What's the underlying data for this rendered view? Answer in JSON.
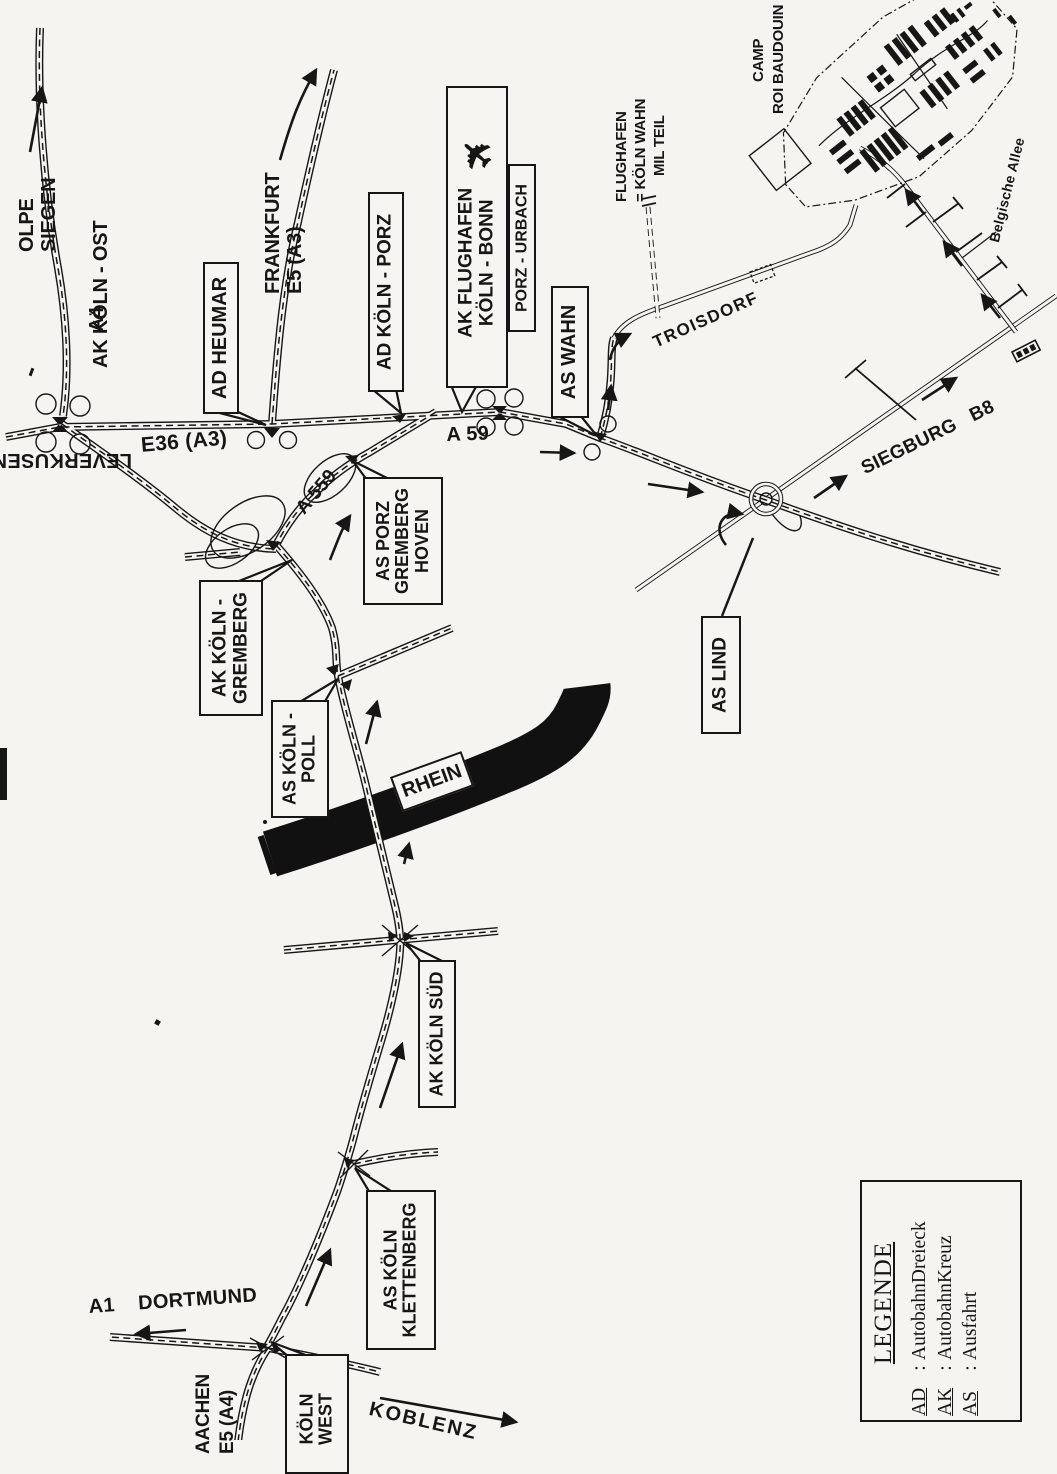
{
  "colors": {
    "paper": "#f5f4f0",
    "ink": "#161616"
  },
  "labels": {
    "olpe": "OLPE",
    "siegen": "SIEGEN",
    "a4": "A4",
    "ak_koeln_ost": "AK KÖLN - OST",
    "frankfurt": "FRANKFURT",
    "e5_a3": "E5 (A3)",
    "e36_a3": "E36 (A3)",
    "leverkusen": "LEVERKUSEN",
    "a_559": "A 559",
    "a_59": "A 59",
    "troisdorf": "TROISDORF",
    "flughafen": "FLUGHAFEN",
    "koeln_wahn": "= KÖLN WAHN",
    "mil_teil": "MIL TEIL",
    "camp": "CAMP",
    "roi_baudouin": "ROI BAUDOUIN",
    "belgische_allee": "Belgische Allee",
    "siegburg_b8": "SIEGBURG   B8",
    "rhein": "RHEIN",
    "a1_dortmund": "A1    DORTMUND",
    "koblenz": "KOBLENZ",
    "aachen": "AACHEN",
    "e5_a4": "E5 (A4)"
  },
  "junction_boxes": {
    "ad_heumar": "AD HEUMAR",
    "ad_koeln_porz": "AD KÖLN - PORZ",
    "ak_flughafen": {
      "line1": "AK FLUGHAFEN",
      "line2": "KÖLN - BONN"
    },
    "porz_urbach": "PORZ - URBACH",
    "as_wahn": "AS WAHN",
    "as_porz_gremberg_hoven": {
      "line1": "AS PORZ",
      "line2": "GREMBERG",
      "line3": "HOVEN"
    },
    "ak_koeln_gremberg": {
      "line1": "AK KÖLN -",
      "line2": "GREMBERG"
    },
    "as_koeln_poll": {
      "line1": "AS KÖLN -",
      "line2": "POLL"
    },
    "as_lind": "AS LIND",
    "ak_koeln_sued": "AK KÖLN SÜD",
    "as_koeln_klettenberg": {
      "line1": "AS KÖLN",
      "line2": "KLETTENBERG"
    },
    "koeln_west": {
      "line1": "KÖLN",
      "line2": "WEST"
    }
  },
  "icons": {
    "airplane": "✈"
  },
  "legend": {
    "title": "LEGENDE",
    "colon": ":",
    "entries": [
      {
        "abbr": "AD",
        "desc": "AutobahnDreieck"
      },
      {
        "abbr": "AK",
        "desc": "AutobahnKreuz"
      },
      {
        "abbr": "AS",
        "desc": "Ausfahrt"
      }
    ]
  }
}
